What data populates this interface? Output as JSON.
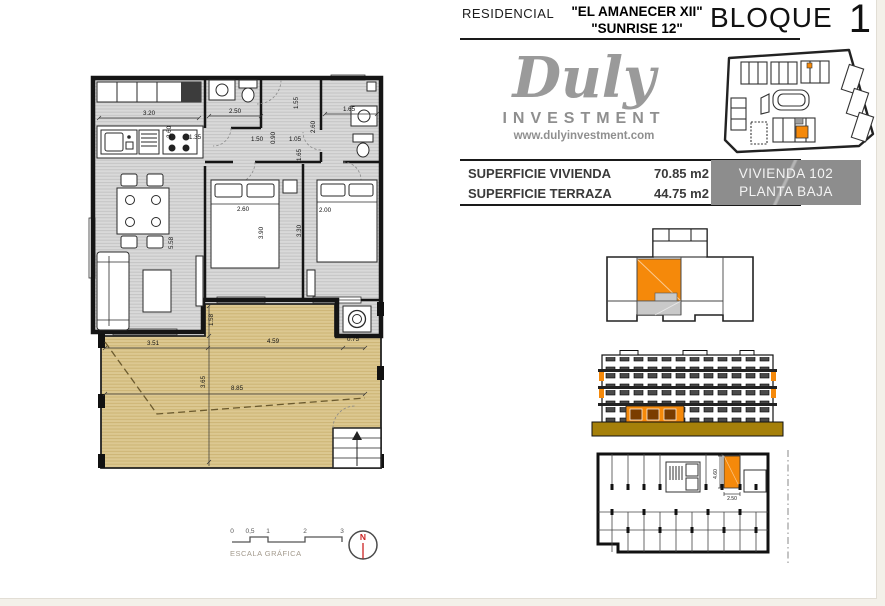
{
  "header": {
    "residencial_label": "RESIDENCIAL",
    "project_name_line1": "\"EL AMANECER XII\"",
    "project_name_line2": "\"SUNRISE 12\"",
    "bloque_label": "BLOQUE",
    "bloque_number": "1"
  },
  "logo": {
    "brand": "Duly",
    "subtitle": "INVESTMENT",
    "website": "www.dulyinvestment.com"
  },
  "areas": {
    "rows": [
      {
        "label": "SUPERFICIE VIVIENDA",
        "value": "70.85 m2"
      },
      {
        "label": "SUPERFICIE TERRAZA",
        "value": "44.75 m2"
      }
    ]
  },
  "unit_box": {
    "unit": "VIVIENDA 102",
    "floor": "PLANTA BAJA"
  },
  "floorplan": {
    "dims": [
      {
        "t": "3.20",
        "x": 64,
        "y": 45,
        "r": 0
      },
      {
        "t": "2.60",
        "x": 86,
        "y": 62,
        "r": -90
      },
      {
        "t": "1.35",
        "x": 110,
        "y": 69,
        "r": 0
      },
      {
        "t": "2.50",
        "x": 150,
        "y": 43,
        "r": 0
      },
      {
        "t": "1.55",
        "x": 213,
        "y": 33,
        "r": -90
      },
      {
        "t": "1.65",
        "x": 264,
        "y": 41,
        "r": 0
      },
      {
        "t": "2.60",
        "x": 230,
        "y": 57,
        "r": -90
      },
      {
        "t": "1.50",
        "x": 172,
        "y": 71,
        "r": 0
      },
      {
        "t": "1.05",
        "x": 210,
        "y": 71,
        "r": 0
      },
      {
        "t": "0.90",
        "x": 190,
        "y": 68,
        "r": -90
      },
      {
        "t": "1.65",
        "x": 216,
        "y": 85,
        "r": -90
      },
      {
        "t": "2.60",
        "x": 158,
        "y": 141,
        "r": 0
      },
      {
        "t": "3.90",
        "x": 178,
        "y": 163,
        "r": -90
      },
      {
        "t": "2.00",
        "x": 240,
        "y": 142,
        "r": 0
      },
      {
        "t": "3.30",
        "x": 216,
        "y": 161,
        "r": -90
      },
      {
        "t": "5.58",
        "x": 88,
        "y": 173,
        "r": -90
      },
      {
        "t": "1.58",
        "x": 128,
        "y": 250,
        "r": -90
      },
      {
        "t": "3.51",
        "x": 68,
        "y": 275,
        "r": 0
      },
      {
        "t": "4.59",
        "x": 188,
        "y": 273,
        "r": 0
      },
      {
        "t": "0.75",
        "x": 268,
        "y": 271,
        "r": 0
      },
      {
        "t": "3.65",
        "x": 120,
        "y": 312,
        "r": -90
      },
      {
        "t": "8.85",
        "x": 152,
        "y": 320,
        "r": 0
      }
    ]
  },
  "garage": {
    "width_dim": "2.50",
    "height_dim": "4.60"
  },
  "scalebar": {
    "ticks": [
      "0",
      "0,5",
      "1",
      "2",
      "3"
    ],
    "label": "ESCALA GRÁFICA"
  },
  "north": {
    "letter": "N"
  },
  "colors": {
    "highlight_orange": "#F5890A",
    "terrace_tan": "#DCC891",
    "unit_box_gray": "#8D8D8D",
    "elevation_base_gold": "#A5800A"
  }
}
